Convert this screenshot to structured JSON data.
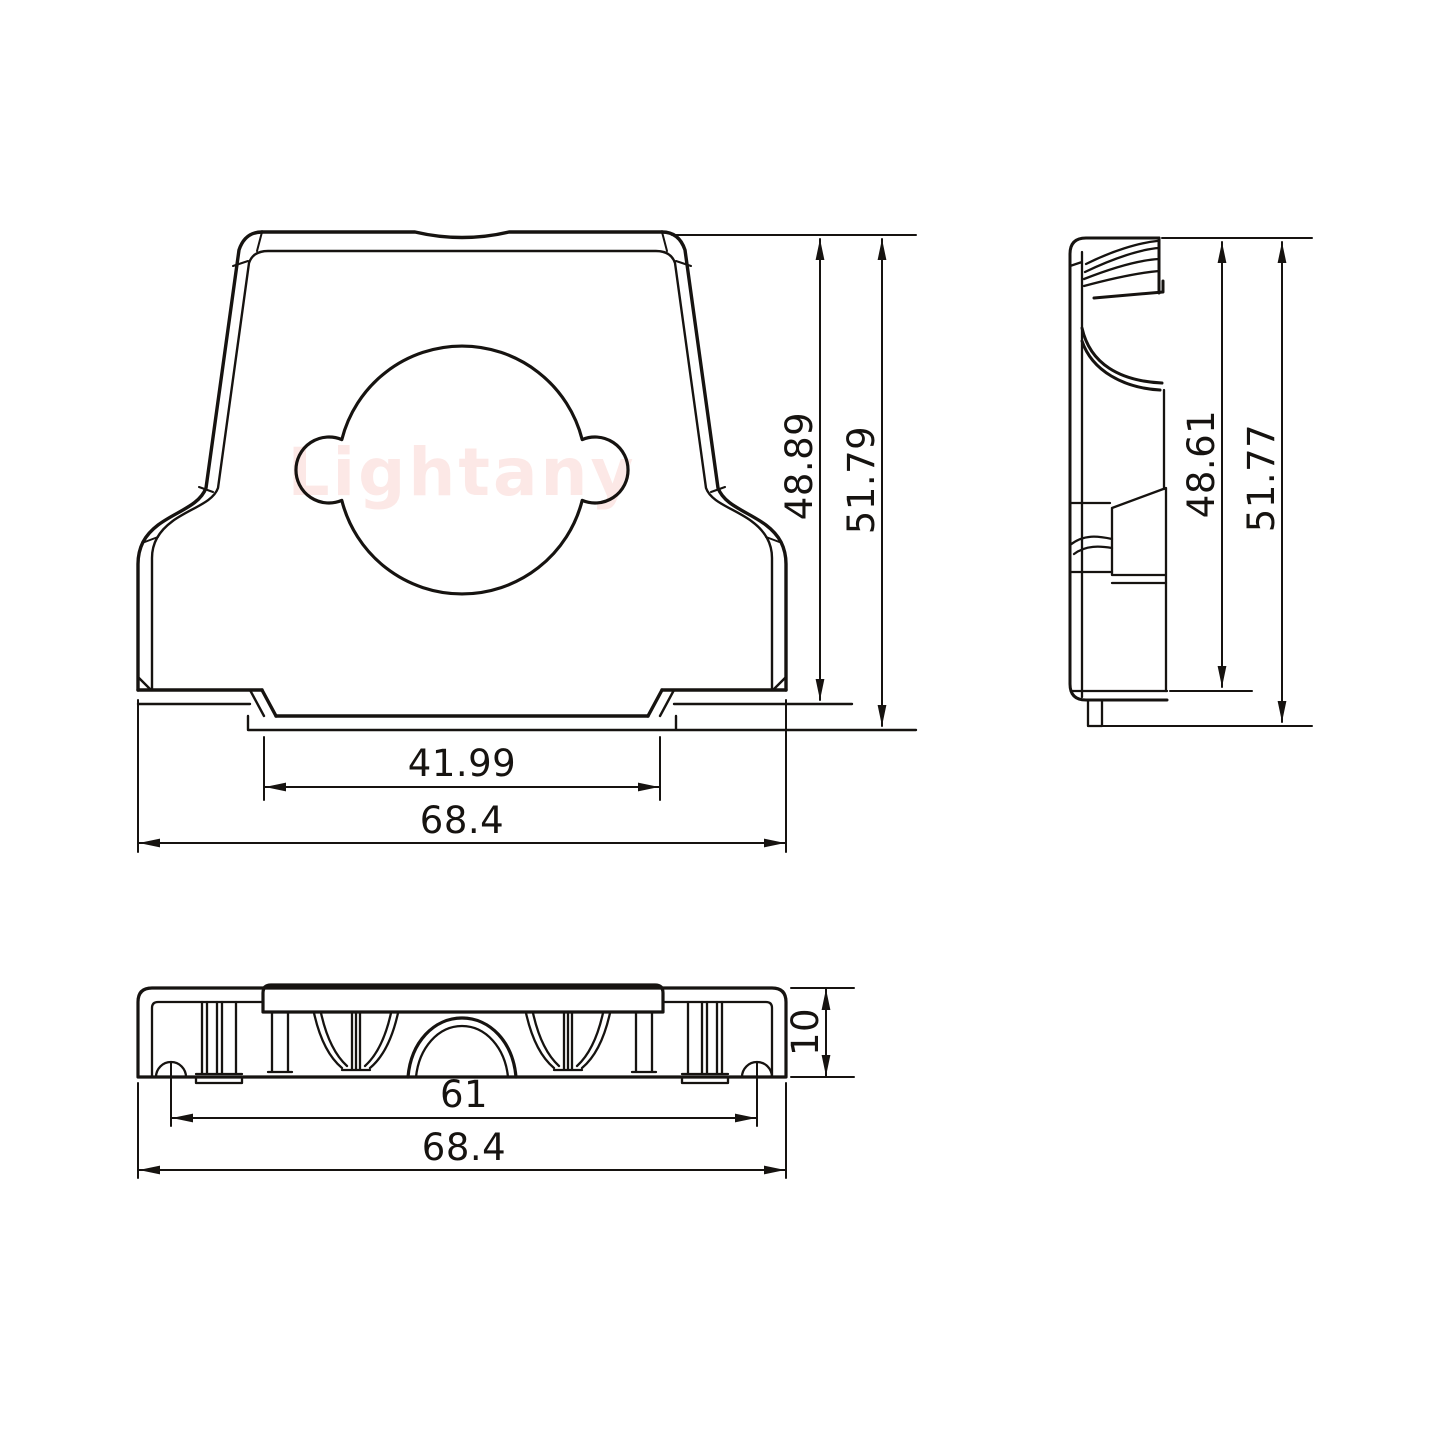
{
  "colors": {
    "line": "#161310",
    "background": "#ffffff"
  },
  "watermark": {
    "text": "Lightany",
    "color": "#fce8e6"
  },
  "views": {
    "front": {
      "dims": {
        "inner_height": "48.89",
        "overall_height": "51.79",
        "inner_width": "41.99",
        "overall_width": "68.4"
      }
    },
    "side": {
      "dims": {
        "inner_height": "48.61",
        "overall_height": "51.77"
      }
    },
    "bottom": {
      "dims": {
        "screw_spacing": "61",
        "overall_width": "68.4",
        "depth": "10"
      }
    }
  }
}
